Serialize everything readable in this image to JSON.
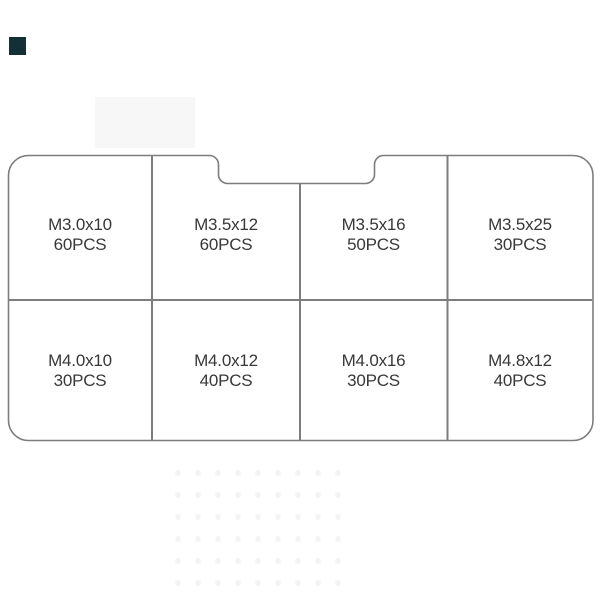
{
  "colors": {
    "background": "#ffffff",
    "line": "#7d7d7d",
    "text": "#383838",
    "faint_rect": "#f7f7f7",
    "dark_square": "#123035"
  },
  "organizer": {
    "rows": [
      {
        "cells": [
          {
            "size": "M3.0x10",
            "qty": "60PCS"
          },
          {
            "size": "M3.5x12",
            "qty": "60PCS"
          },
          {
            "size": "M3.5x16",
            "qty": "50PCS"
          },
          {
            "size": "M3.5x25",
            "qty": "30PCS"
          }
        ]
      },
      {
        "cells": [
          {
            "size": "M4.0x10",
            "qty": "30PCS"
          },
          {
            "size": "M4.0x12",
            "qty": "40PCS"
          },
          {
            "size": "M4.0x16",
            "qty": "30PCS"
          },
          {
            "size": "M4.8x12",
            "qty": "40PCS"
          }
        ]
      }
    ]
  }
}
